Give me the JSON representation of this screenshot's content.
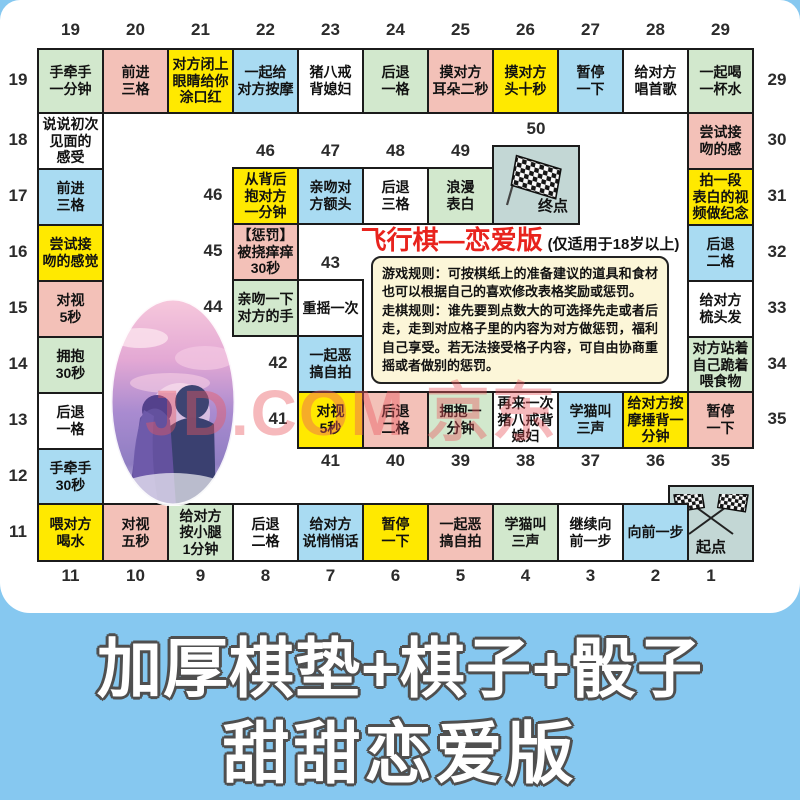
{
  "page": {
    "watermark": "JD.COM 京东",
    "banner": {
      "line1": "加厚棋垫+棋子+骰子",
      "line2": "甜甜恋爱版"
    }
  },
  "board": {
    "title": {
      "main": "飞行棋—恋爱版",
      "note": "(仅适用于18岁以上)"
    },
    "rules": [
      "游戏规则：可按棋纸上的准备建议的道具和食材也可以根据自己的喜欢修改表格奖励或惩罚。",
      "走棋规则：谁先要到点数大的可选择先走或者后走，走到对应格子里的内容为对方做惩罚，福利自己享受。若无法接受格子内容，可自由协商重摇或者做别的惩罚。"
    ],
    "palette": {
      "yellow": "#ffe900",
      "green": "#d2e8cd",
      "pink": "#f3c1b8",
      "blue": "#a9dbf2",
      "white": "#ffffff",
      "corner": "#c3d7d5",
      "border": "#1b1b1b",
      "title_red": "#e8231d",
      "rules_bg": "#fcf6d8",
      "banner_bg": "#86c8f0",
      "watermark": "rgba(233,88,96,0.42)"
    },
    "start_label": "起点",
    "finish_label": "终点",
    "cells": [
      {
        "num": 1,
        "text": "起点",
        "color": "corner",
        "x": 668,
        "y": 485,
        "w": 86,
        "h": 77,
        "labels": [
          "bottom"
        ],
        "icon": "flags-crossed"
      },
      {
        "num": 2,
        "text": "向前一步",
        "color": "blue",
        "x": 622,
        "y": 503,
        "w": 67,
        "h": 59,
        "labels": [
          "bottom"
        ]
      },
      {
        "num": 3,
        "text": "继续向\n前一步",
        "color": "white",
        "x": 557,
        "y": 503,
        "w": 67,
        "h": 59,
        "labels": [
          "bottom"
        ]
      },
      {
        "num": 4,
        "text": "学猫叫\n三声",
        "color": "green",
        "x": 492,
        "y": 503,
        "w": 67,
        "h": 59,
        "labels": [
          "bottom"
        ]
      },
      {
        "num": 5,
        "text": "一起恶\n搞自拍",
        "color": "pink",
        "x": 427,
        "y": 503,
        "w": 67,
        "h": 59,
        "labels": [
          "bottom"
        ]
      },
      {
        "num": 6,
        "text": "暂停\n一下",
        "color": "yellow",
        "x": 362,
        "y": 503,
        "w": 67,
        "h": 59,
        "labels": [
          "bottom"
        ]
      },
      {
        "num": 7,
        "text": "给对方\n说悄悄话",
        "color": "blue",
        "x": 297,
        "y": 503,
        "w": 67,
        "h": 59,
        "labels": [
          "bottom"
        ]
      },
      {
        "num": 8,
        "text": "后退\n二格",
        "color": "white",
        "x": 232,
        "y": 503,
        "w": 67,
        "h": 59,
        "labels": [
          "bottom"
        ]
      },
      {
        "num": 9,
        "text": "给对方\n按小腿\n1分钟",
        "color": "green",
        "x": 167,
        "y": 503,
        "w": 67,
        "h": 59,
        "labels": [
          "bottom"
        ]
      },
      {
        "num": 10,
        "text": "对视\n五秒",
        "color": "pink",
        "x": 102,
        "y": 503,
        "w": 67,
        "h": 59,
        "labels": [
          "bottom"
        ]
      },
      {
        "num": 11,
        "text": "喂对方\n喝水",
        "color": "yellow",
        "x": 37,
        "y": 503,
        "w": 67,
        "h": 59,
        "labels": [
          "left",
          "bottom"
        ]
      },
      {
        "num": 12,
        "text": "手牵手\n30秒",
        "color": "blue",
        "x": 37,
        "y": 448,
        "w": 67,
        "h": 57,
        "labels": [
          "left"
        ]
      },
      {
        "num": 13,
        "text": "后退\n一格",
        "color": "white",
        "x": 37,
        "y": 392,
        "w": 67,
        "h": 58,
        "labels": [
          "left"
        ]
      },
      {
        "num": 14,
        "text": "拥抱\n30秒",
        "color": "green",
        "x": 37,
        "y": 336,
        "w": 67,
        "h": 58,
        "labels": [
          "left"
        ]
      },
      {
        "num": 15,
        "text": "对视\n5秒",
        "color": "pink",
        "x": 37,
        "y": 280,
        "w": 67,
        "h": 58,
        "labels": [
          "left"
        ]
      },
      {
        "num": 16,
        "text": "尝试接\n吻的感觉",
        "color": "yellow",
        "x": 37,
        "y": 224,
        "w": 67,
        "h": 58,
        "labels": [
          "left"
        ]
      },
      {
        "num": 17,
        "text": "前进\n三格",
        "color": "blue",
        "x": 37,
        "y": 168,
        "w": 67,
        "h": 58,
        "labels": [
          "left"
        ]
      },
      {
        "num": 18,
        "text": "说说初次\n见面的\n感受",
        "color": "white",
        "x": 37,
        "y": 112,
        "w": 67,
        "h": 58,
        "labels": [
          "left"
        ]
      },
      {
        "num": 19,
        "text": "手牵手\n一分钟",
        "color": "green",
        "x": 37,
        "y": 48,
        "w": 67,
        "h": 66,
        "labels": [
          "top",
          "left"
        ]
      },
      {
        "num": 20,
        "text": "前进\n三格",
        "color": "pink",
        "x": 102,
        "y": 48,
        "w": 67,
        "h": 66,
        "labels": [
          "top"
        ]
      },
      {
        "num": 21,
        "text": "对方闭上\n眼睛给你\n涂口红",
        "color": "yellow",
        "x": 167,
        "y": 48,
        "w": 67,
        "h": 66,
        "labels": [
          "top"
        ]
      },
      {
        "num": 22,
        "text": "一起给\n对方按摩",
        "color": "blue",
        "x": 232,
        "y": 48,
        "w": 67,
        "h": 66,
        "labels": [
          "top"
        ]
      },
      {
        "num": 23,
        "text": "猪八戒\n背媳妇",
        "color": "white",
        "x": 297,
        "y": 48,
        "w": 67,
        "h": 66,
        "labels": [
          "top"
        ]
      },
      {
        "num": 24,
        "text": "后退\n一格",
        "color": "green",
        "x": 362,
        "y": 48,
        "w": 67,
        "h": 66,
        "labels": [
          "top"
        ]
      },
      {
        "num": 25,
        "text": "摸对方\n耳朵二秒",
        "color": "pink",
        "x": 427,
        "y": 48,
        "w": 67,
        "h": 66,
        "labels": [
          "top"
        ]
      },
      {
        "num": 26,
        "text": "摸对方\n头十秒",
        "color": "yellow",
        "x": 492,
        "y": 48,
        "w": 67,
        "h": 66,
        "labels": [
          "top"
        ]
      },
      {
        "num": 27,
        "text": "暂停\n一下",
        "color": "blue",
        "x": 557,
        "y": 48,
        "w": 67,
        "h": 66,
        "labels": [
          "top"
        ]
      },
      {
        "num": 28,
        "text": "给对方\n唱首歌",
        "color": "white",
        "x": 622,
        "y": 48,
        "w": 67,
        "h": 66,
        "labels": [
          "top"
        ]
      },
      {
        "num": 29,
        "text": "一起喝\n一杯水",
        "color": "green",
        "x": 687,
        "y": 48,
        "w": 67,
        "h": 66,
        "labels": [
          "top",
          "right"
        ]
      },
      {
        "num": 30,
        "text": "尝试接\n吻的感",
        "color": "pink",
        "x": 687,
        "y": 112,
        "w": 67,
        "h": 58,
        "labels": [
          "right"
        ]
      },
      {
        "num": 31,
        "text": "拍一段\n表白的视\n频做纪念",
        "color": "yellow",
        "x": 687,
        "y": 168,
        "w": 67,
        "h": 58,
        "labels": [
          "right"
        ]
      },
      {
        "num": 32,
        "text": "后退\n二格",
        "color": "blue",
        "x": 687,
        "y": 224,
        "w": 67,
        "h": 58,
        "labels": [
          "right"
        ]
      },
      {
        "num": 33,
        "text": "给对方\n梳头发",
        "color": "white",
        "x": 687,
        "y": 280,
        "w": 67,
        "h": 58,
        "labels": [
          "right"
        ]
      },
      {
        "num": 34,
        "text": "对方站着\n自己跪着\n喂食物",
        "color": "green",
        "x": 687,
        "y": 336,
        "w": 67,
        "h": 58,
        "labels": [
          "right"
        ]
      },
      {
        "num": 35,
        "text": "暂停\n一下",
        "color": "pink",
        "x": 687,
        "y": 391,
        "w": 67,
        "h": 58,
        "labels": [
          "right",
          "below"
        ]
      },
      {
        "num": 36,
        "text": "给对方按\n摩捶背一\n分钟",
        "color": "yellow",
        "x": 622,
        "y": 391,
        "w": 67,
        "h": 58,
        "labels": [
          "below"
        ]
      },
      {
        "num": 37,
        "text": "学猫叫\n三声",
        "color": "blue",
        "x": 557,
        "y": 391,
        "w": 67,
        "h": 58,
        "labels": [
          "below"
        ]
      },
      {
        "num": 38,
        "text": "再来一次\n猪八戒背\n媳妇",
        "color": "white",
        "x": 492,
        "y": 391,
        "w": 67,
        "h": 58,
        "labels": [
          "below"
        ]
      },
      {
        "num": 39,
        "text": "拥抱一\n分钟",
        "color": "green",
        "x": 427,
        "y": 391,
        "w": 67,
        "h": 58,
        "labels": [
          "below"
        ]
      },
      {
        "num": 40,
        "text": "后退\n二格",
        "color": "pink",
        "x": 362,
        "y": 391,
        "w": 67,
        "h": 58,
        "labels": [
          "below"
        ]
      },
      {
        "num": 41,
        "text": "对视\n5秒",
        "color": "yellow",
        "x": 297,
        "y": 391,
        "w": 67,
        "h": 58,
        "labels": [
          "left",
          "below"
        ]
      },
      {
        "num": 42,
        "text": "一起恶\n搞自拍",
        "color": "blue",
        "x": 297,
        "y": 335,
        "w": 67,
        "h": 58,
        "labels": [
          "left"
        ]
      },
      {
        "num": 43,
        "text": "重摇一次",
        "color": "white",
        "x": 297,
        "y": 279,
        "w": 67,
        "h": 58,
        "labels": [
          "above"
        ]
      },
      {
        "num": 44,
        "text": "亲吻一下\n对方的手",
        "color": "green",
        "x": 232,
        "y": 279,
        "w": 67,
        "h": 58,
        "labels": [
          "left"
        ]
      },
      {
        "num": 45,
        "text": "【惩罚】\n被挠痒痒\n30秒",
        "color": "pink",
        "x": 232,
        "y": 223,
        "w": 67,
        "h": 58,
        "labels": [
          "left"
        ]
      },
      {
        "num": 46,
        "text": "从背后\n抱对方\n一分钟",
        "color": "yellow",
        "x": 232,
        "y": 167,
        "w": 67,
        "h": 58,
        "labels": [
          "left",
          "above"
        ]
      },
      {
        "num": 47,
        "text": "亲吻对\n方额头",
        "color": "blue",
        "x": 297,
        "y": 167,
        "w": 67,
        "h": 58,
        "labels": [
          "above"
        ]
      },
      {
        "num": 48,
        "text": "后退\n三格",
        "color": "white",
        "x": 362,
        "y": 167,
        "w": 67,
        "h": 58,
        "labels": [
          "above"
        ]
      },
      {
        "num": 49,
        "text": "浪漫\n表白",
        "color": "green",
        "x": 427,
        "y": 167,
        "w": 67,
        "h": 58,
        "labels": [
          "above"
        ]
      },
      {
        "num": 50,
        "text": "终点",
        "color": "corner",
        "x": 492,
        "y": 145,
        "w": 88,
        "h": 80,
        "labels": [
          "above"
        ],
        "icon": "flag"
      }
    ]
  }
}
